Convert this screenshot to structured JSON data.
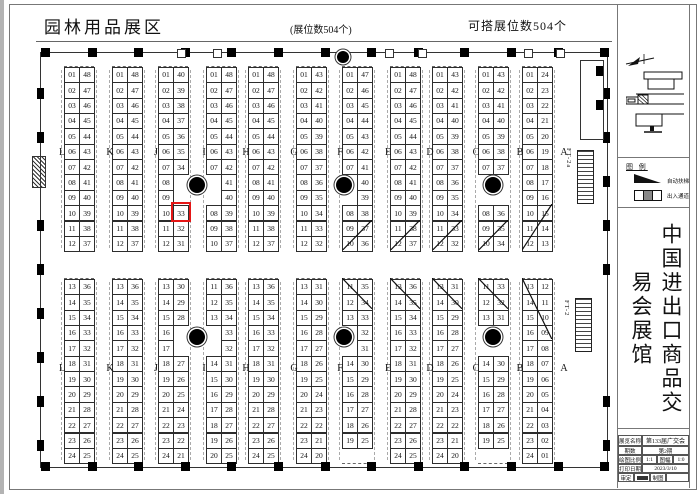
{
  "header": {
    "title": "园林用品展区",
    "booth_count": "(展位数504个)",
    "buildable_count": "可搭展位数504个"
  },
  "plan": {
    "aisle_letters": [
      "L",
      "K",
      "J",
      "I",
      "H",
      "G",
      "F",
      "E",
      "D",
      "C",
      "B",
      "A"
    ],
    "escalators": [
      {
        "label": "FT-2a"
      },
      {
        "label": "FT-2"
      }
    ],
    "highlight": {
      "half": "top",
      "strip": 2,
      "row": 9,
      "col": 1,
      "booth": "33",
      "color": "#e51616"
    },
    "top_strips": [
      {
        "rows": [
          [
            "01",
            "48"
          ],
          [
            "02",
            "47"
          ],
          [
            "03",
            "46"
          ],
          [
            "04",
            "45"
          ],
          [
            "05",
            "44"
          ],
          [
            "06",
            "43"
          ],
          [
            "07",
            "42"
          ],
          [
            "08",
            "41"
          ],
          [
            "09",
            "40"
          ],
          [
            "10",
            "39"
          ],
          [
            "11",
            "38"
          ],
          [
            "12",
            "37"
          ]
        ]
      },
      {
        "rows": [
          [
            "01",
            "48"
          ],
          [
            "02",
            "47"
          ],
          [
            "03",
            "46"
          ],
          [
            "04",
            "45"
          ],
          [
            "05",
            "44"
          ],
          [
            "06",
            "43"
          ],
          [
            "07",
            "42"
          ],
          [
            "08",
            "41"
          ],
          [
            "09",
            "40"
          ],
          [
            "10",
            "39"
          ],
          [
            "11",
            "38"
          ],
          [
            "12",
            "37"
          ]
        ]
      },
      {
        "rows": [
          [
            "01",
            "40"
          ],
          [
            "02",
            "39"
          ],
          [
            "03",
            "38"
          ],
          [
            "04",
            "37"
          ],
          [
            "05",
            "36"
          ],
          [
            "06",
            "35"
          ],
          [
            "07",
            "34"
          ],
          [
            "08",
            ""
          ],
          [
            "09",
            ""
          ],
          [
            "10",
            "33"
          ],
          [
            "11",
            "32"
          ],
          [
            "12",
            "31"
          ]
        ]
      },
      {
        "rows": [
          [
            "01",
            "48"
          ],
          [
            "02",
            "47"
          ],
          [
            "03",
            "46"
          ],
          [
            "04",
            "45"
          ],
          [
            "05",
            "44"
          ],
          [
            "06",
            "43"
          ],
          [
            "07",
            "42"
          ],
          [
            "",
            "41"
          ],
          [
            "",
            "40"
          ],
          [
            "08",
            "39"
          ],
          [
            "09",
            "38"
          ],
          [
            "10",
            "37"
          ]
        ]
      },
      {
        "rows": [
          [
            "01",
            "48"
          ],
          [
            "02",
            "47"
          ],
          [
            "03",
            "46"
          ],
          [
            "04",
            "45"
          ],
          [
            "05",
            "44"
          ],
          [
            "06",
            "43"
          ],
          [
            "07",
            "42"
          ],
          [
            "08",
            "41"
          ],
          [
            "09",
            "40"
          ],
          [
            "10",
            "39"
          ],
          [
            "11",
            "38"
          ],
          [
            "12",
            "37"
          ]
        ]
      },
      {
        "rows": [
          [
            "01",
            "43"
          ],
          [
            "02",
            "42"
          ],
          [
            "03",
            "41"
          ],
          [
            "04",
            "40"
          ],
          [
            "05",
            "39"
          ],
          [
            "06",
            "38"
          ],
          [
            "07",
            "37"
          ],
          [
            "08",
            "36"
          ],
          [
            "09",
            "35"
          ],
          [
            "10",
            "34"
          ],
          [
            "11",
            "33"
          ],
          [
            "12",
            "32"
          ]
        ]
      },
      {
        "rows": [
          [
            "01",
            "47"
          ],
          [
            "02",
            "46"
          ],
          [
            "03",
            "45"
          ],
          [
            "04",
            "44"
          ],
          [
            "05",
            "43"
          ],
          [
            "06",
            "42"
          ],
          [
            "07",
            "41"
          ],
          [
            "",
            "40"
          ],
          [
            "",
            "39"
          ],
          [
            "08",
            "38"
          ],
          [
            "09",
            "37"
          ],
          [
            "10",
            "36"
          ]
        ],
        "cross": [
          10,
          11
        ]
      },
      {
        "rows": [
          [
            "01",
            "48"
          ],
          [
            "02",
            "47"
          ],
          [
            "03",
            "46"
          ],
          [
            "04",
            "45"
          ],
          [
            "05",
            "44"
          ],
          [
            "06",
            "43"
          ],
          [
            "07",
            "42"
          ],
          [
            "08",
            "41"
          ],
          [
            "09",
            "40"
          ],
          [
            "10",
            "39"
          ],
          [
            "11",
            "38"
          ],
          [
            "12",
            "37"
          ]
        ],
        "cross": [
          10,
          11
        ]
      },
      {
        "rows": [
          [
            "01",
            "43"
          ],
          [
            "02",
            "42"
          ],
          [
            "03",
            "41"
          ],
          [
            "04",
            "40"
          ],
          [
            "05",
            "39"
          ],
          [
            "06",
            "38"
          ],
          [
            "07",
            "37"
          ],
          [
            "08",
            "36"
          ],
          [
            "09",
            "35"
          ],
          [
            "10",
            "34"
          ],
          [
            "11",
            "33"
          ],
          [
            "12",
            "32"
          ]
        ],
        "cross": [
          10,
          11
        ]
      },
      {
        "rows": [
          [
            "01",
            "43"
          ],
          [
            "02",
            "42"
          ],
          [
            "03",
            "41"
          ],
          [
            "04",
            "40"
          ],
          [
            "05",
            "39"
          ],
          [
            "06",
            "38"
          ],
          [
            "07",
            "37"
          ],
          [
            "",
            ""
          ],
          [
            "",
            ""
          ],
          [
            "08",
            "36"
          ],
          [
            "09",
            "35"
          ],
          [
            "10",
            "34"
          ]
        ],
        "cross": [
          10,
          11
        ]
      },
      {
        "rows": [
          [
            "01",
            "24"
          ],
          [
            "02",
            "23"
          ],
          [
            "03",
            "22"
          ],
          [
            "04",
            "21"
          ],
          [
            "05",
            "20"
          ],
          [
            "06",
            "19"
          ],
          [
            "07",
            "18"
          ],
          [
            "08",
            "17"
          ],
          [
            "09",
            "16"
          ],
          [
            "10",
            "15"
          ],
          [
            "11",
            "14"
          ],
          [
            "12",
            "13"
          ]
        ],
        "cross": [
          9,
          11
        ]
      }
    ],
    "bottom_strips": [
      {
        "rows": [
          [
            "13",
            "36"
          ],
          [
            "14",
            "35"
          ],
          [
            "15",
            "34"
          ],
          [
            "16",
            "33"
          ],
          [
            "17",
            "32"
          ],
          [
            "18",
            "31"
          ],
          [
            "19",
            "30"
          ],
          [
            "20",
            "29"
          ],
          [
            "21",
            "28"
          ],
          [
            "22",
            "27"
          ],
          [
            "23",
            "26"
          ],
          [
            "24",
            "25"
          ]
        ]
      },
      {
        "rows": [
          [
            "13",
            "36"
          ],
          [
            "14",
            "35"
          ],
          [
            "15",
            "34"
          ],
          [
            "16",
            "33"
          ],
          [
            "17",
            "32"
          ],
          [
            "18",
            "31"
          ],
          [
            "19",
            "30"
          ],
          [
            "20",
            "29"
          ],
          [
            "21",
            "28"
          ],
          [
            "22",
            "27"
          ],
          [
            "23",
            "26"
          ],
          [
            "24",
            "25"
          ]
        ]
      },
      {
        "rows": [
          [
            "13",
            "30"
          ],
          [
            "14",
            "29"
          ],
          [
            "15",
            "28"
          ],
          [
            "16",
            ""
          ],
          [
            "17",
            ""
          ],
          [
            "18",
            "27"
          ],
          [
            "19",
            "26"
          ],
          [
            "20",
            "25"
          ],
          [
            "21",
            "24"
          ],
          [
            "22",
            "23"
          ],
          [
            "23",
            "22"
          ],
          [
            "24",
            "21"
          ]
        ]
      },
      {
        "rows": [
          [
            "11",
            "36"
          ],
          [
            "12",
            "35"
          ],
          [
            "13",
            "34"
          ],
          [
            "",
            "33"
          ],
          [
            "",
            "32"
          ],
          [
            "14",
            "31"
          ],
          [
            "15",
            "30"
          ],
          [
            "16",
            "29"
          ],
          [
            "17",
            "28"
          ],
          [
            "18",
            "27"
          ],
          [
            "19",
            "26"
          ],
          [
            "20",
            "25"
          ]
        ]
      },
      {
        "rows": [
          [
            "13",
            "36"
          ],
          [
            "14",
            "35"
          ],
          [
            "15",
            "34"
          ],
          [
            "16",
            "33"
          ],
          [
            "17",
            "32"
          ],
          [
            "18",
            "31"
          ],
          [
            "19",
            "30"
          ],
          [
            "20",
            "29"
          ],
          [
            "21",
            "28"
          ],
          [
            "22",
            "27"
          ],
          [
            "23",
            "26"
          ],
          [
            "24",
            "25"
          ]
        ]
      },
      {
        "rows": [
          [
            "13",
            "31"
          ],
          [
            "14",
            "30"
          ],
          [
            "15",
            "29"
          ],
          [
            "16",
            "28"
          ],
          [
            "17",
            "27"
          ],
          [
            "18",
            "26"
          ],
          [
            "19",
            "25"
          ],
          [
            "20",
            "24"
          ],
          [
            "21",
            "23"
          ],
          [
            "22",
            "22"
          ],
          [
            "23",
            "21"
          ],
          [
            "24",
            "20"
          ]
        ]
      },
      {
        "rows": [
          [
            "11",
            "35"
          ],
          [
            "12",
            "34"
          ],
          [
            "13",
            "33"
          ],
          [
            "",
            "32"
          ],
          [
            "",
            "31"
          ],
          [
            "14",
            "30"
          ],
          [
            "15",
            "29"
          ],
          [
            "16",
            "28"
          ],
          [
            "17",
            "27"
          ],
          [
            "18",
            "26"
          ],
          [
            "19",
            "25"
          ],
          [
            "",
            ""
          ]
        ],
        "cross": [
          0,
          1
        ]
      },
      {
        "rows": [
          [
            "13",
            "36"
          ],
          [
            "14",
            "35"
          ],
          [
            "15",
            "34"
          ],
          [
            "16",
            "33"
          ],
          [
            "17",
            "32"
          ],
          [
            "18",
            "31"
          ],
          [
            "19",
            "30"
          ],
          [
            "20",
            "29"
          ],
          [
            "21",
            "28"
          ],
          [
            "22",
            "27"
          ],
          [
            "23",
            "26"
          ],
          [
            "24",
            "25"
          ]
        ],
        "cross": [
          0,
          1
        ]
      },
      {
        "rows": [
          [
            "13",
            "31"
          ],
          [
            "14",
            "30"
          ],
          [
            "15",
            "29"
          ],
          [
            "16",
            "28"
          ],
          [
            "17",
            "27"
          ],
          [
            "18",
            "26"
          ],
          [
            "19",
            "25"
          ],
          [
            "20",
            "24"
          ],
          [
            "21",
            "23"
          ],
          [
            "22",
            "22"
          ],
          [
            "23",
            "21"
          ],
          [
            "24",
            "20"
          ]
        ],
        "cross": [
          0,
          1
        ]
      },
      {
        "rows": [
          [
            "11",
            "33"
          ],
          [
            "12",
            "32"
          ],
          [
            "13",
            "31"
          ],
          [
            "",
            ""
          ],
          [
            "",
            ""
          ],
          [
            "14",
            "30"
          ],
          [
            "15",
            "29"
          ],
          [
            "16",
            "28"
          ],
          [
            "17",
            "27"
          ],
          [
            "18",
            "26"
          ],
          [
            "19",
            "25"
          ],
          [
            "",
            ""
          ]
        ],
        "cross": [
          0,
          1
        ]
      },
      {
        "rows": [
          [
            "13",
            "12"
          ],
          [
            "14",
            "11"
          ],
          [
            "15",
            "10"
          ],
          [
            "16",
            "09"
          ],
          [
            "17",
            "08"
          ],
          [
            "18",
            "07"
          ],
          [
            "19",
            "06"
          ],
          [
            "20",
            "05"
          ],
          [
            "21",
            "04"
          ],
          [
            "22",
            "03"
          ],
          [
            "23",
            "02"
          ],
          [
            "24",
            "01"
          ]
        ],
        "cross": [
          0,
          3
        ]
      }
    ]
  },
  "sidebar": {
    "legend": {
      "title": "图 例",
      "items": [
        {
          "label": "自动扶梯"
        },
        {
          "label": "出入通道"
        }
      ]
    },
    "hall_title": "中国进出口商品交易会展馆",
    "titleblock": {
      "exhibition_label": "展览名称",
      "exhibition": "第133届广交会",
      "phase_label": "期数",
      "phase": "第2期",
      "scale_label": "绘图比例",
      "scale": "1:1",
      "sheet_label": "图幅",
      "sheet": "1:0",
      "date_label": "打印日期",
      "date": "2023/3/10",
      "approve_label": "审定",
      "draw_label": "制图"
    }
  }
}
